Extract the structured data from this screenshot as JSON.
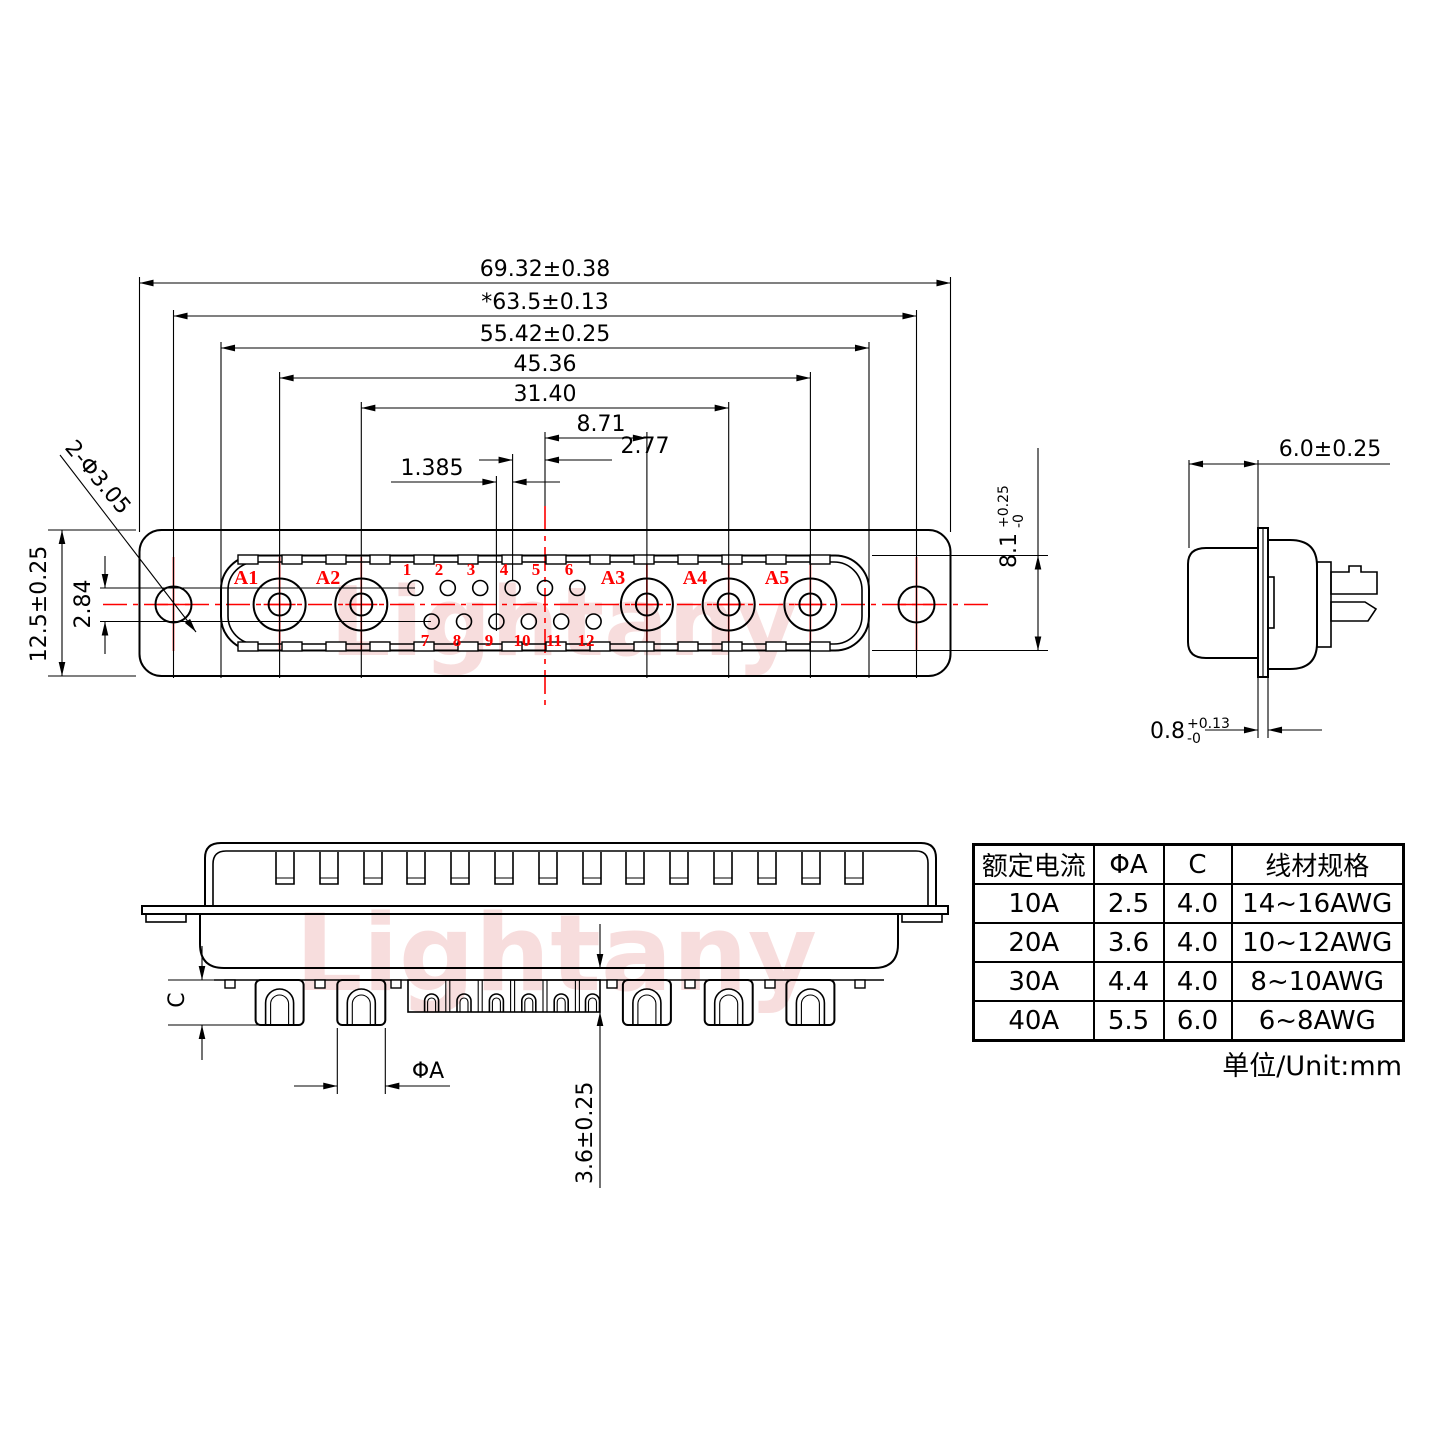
{
  "watermark": {
    "text": "Lightany"
  },
  "colors": {
    "line": "#000000",
    "accent_red": "#fe0000",
    "watermark_pink": "#f2c2c2"
  },
  "face_view": {
    "dims": {
      "total_width": "69.32±0.38",
      "mount_hole_span": "*63.5±0.13",
      "shell_width": "55.42±0.25",
      "a1_a5_span": "45.36",
      "a2_a4_span": "31.40",
      "center_to_a3": "8.71",
      "pin_pitch": "2.77",
      "half_pitch": "1.385",
      "flange_height": "12.5±0.25",
      "row_offset": "2.84",
      "mount_hole_note": "2-Φ3.05"
    },
    "contact_labels": [
      "A1",
      "A2",
      "A3",
      "A4",
      "A5"
    ],
    "pin_labels_top": [
      "1",
      "2",
      "3",
      "4",
      "5",
      "6"
    ],
    "pin_labels_bottom": [
      "7",
      "8",
      "9",
      "10",
      "11",
      "12"
    ]
  },
  "side_view": {
    "dims": {
      "shell_depth": "6.0±0.25",
      "shell_height": {
        "value": "8.1",
        "plus": "+0.25",
        "minus": "-0"
      },
      "flange_thickness": {
        "value": "0.8",
        "plus": "+0.13",
        "minus": "-0"
      }
    }
  },
  "bottom_view": {
    "dims": {
      "cup_length": "C",
      "pin_diameter": "ΦA",
      "pin_protrusion": "3.6±0.25"
    }
  },
  "spec_table": {
    "headers": [
      "额定电流",
      "ΦA",
      "C",
      "线材规格"
    ],
    "rows": [
      [
        "10A",
        "2.5",
        "4.0",
        "14~16AWG"
      ],
      [
        "20A",
        "3.6",
        "4.0",
        "10~12AWG"
      ],
      [
        "30A",
        "4.4",
        "4.0",
        "8~10AWG"
      ],
      [
        "40A",
        "5.5",
        "6.0",
        "6~8AWG"
      ]
    ],
    "unit_note": "单位/Unit:mm"
  }
}
